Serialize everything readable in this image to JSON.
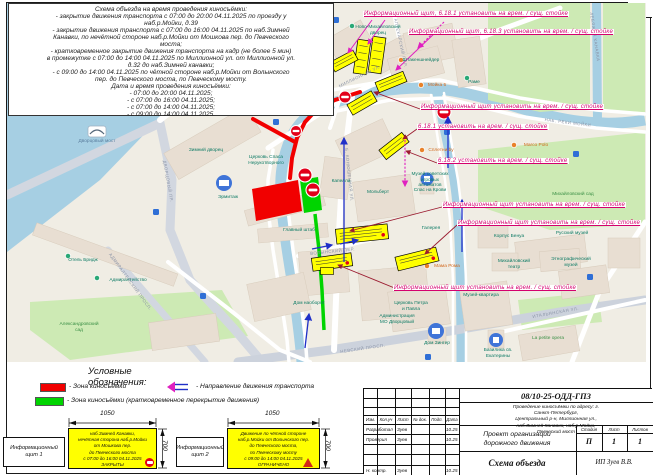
{
  "sheet": {
    "number": "16",
    "info_text": "Схема объезда на время проведения киносъёмки:\n- закрытие движения транспорта с 07:00 до 20:00 04.11.2025 по проезду у\nнаб.р.Мойки, д.39\n- закрытие движения транспорта с 07:00 до 16:00 04.11.2025 по наб.Зимней\nКанавки, по нечётной стороне наб.р.Мойки от Мошкова пер. до Певческого\nмоста;\n- кратковременное закрытие движения транспорта на кадр (не более 5 мин)\nв промежутке с 07:00 до 14:00 04.11.2025 по Миллионной ул. от Миллионной ул.\nд.32 до наб.Зимней канавки;\n- с 09:00 до 14:00 04.11.2025 по чётной стороне наб.р.Мойки от Волынского\nпер. до Певческого моста, по Певческому мосту.\nДата и время проведения киносъёмки:\n- 07:00 до 20:00 04.11.2025;\n- с 07:00 до 16:00 04.11.2025;\n- с 07:00 до 14:00 04.11.2025;\n- с 09:00 до 14:00 04.11.2025."
  },
  "annotations": [
    "Информационный щит, 6.18.1 установить на врем. / сущ. стойке",
    "Информационный щит, 6.18.3 установить на врем. / сущ. стойке",
    "Информационный щит установить на врем. / сущ. стойке",
    "6.18.1 установить на врем. / сущ. стойке",
    "6.18.2 установить на врем. / сущ. стойке",
    "Информационный щит установить на врем. / сущ. стойке",
    "Информационный щит установить на врем. / сущ. стойке",
    "Информационный щит установить на врем. / сущ. стойке"
  ],
  "map": {
    "pois": [
      "Эрмитажный театр",
      "Ново-Михайловский\nдворец",
      "Штакеншнейдер",
      "Мойка 5",
      "Раме",
      "Зимний дворец",
      "Эрмитаж",
      "Церковь Спаса\nНерукотворного",
      "Капелла",
      "Главный штаб",
      "Мольберт",
      "Музей советских\nигровых\nавтоматов",
      "Спас на Крови",
      "Михайловский сад",
      "Галерея",
      "Корпус Бенуа",
      "Русский музей",
      "Михайловский\nтеатр",
      "Этнографический\nмузей",
      "Мама Рома",
      "Музей-квартира",
      "Церковь Петра\nи Павла",
      "Администрация\nМО Дворцовый",
      "Дом наоборот",
      "Дом Зингер",
      "Базилика св.\nЕкатерины",
      "La petite opera",
      "Адмиралтейство",
      "Александровский\nсад",
      "Отель Бридж",
      "Дворцовый мост",
      "Marco Polo",
      "Сплетни.by"
    ],
    "streets": [
      "НАБ. РЕКИ МОЙКИ",
      "НЕВСКИЙ ПРОСП.",
      "АДМИРАЛТЕЙСКИЙ ПРОСП.",
      "ДВОРЦОВЫЙ ПР.",
      "МИЛЛИОННАЯ УЛ.",
      "ИТАЛЬЯНСКАЯ УЛ.",
      "АПТЕКАРСКИЙ ПЕР.",
      "ВОЛЫНСКИЙ ПЕР.",
      "Б. КОНЮШЕННАЯ УЛ.",
      "ЛЕБЯЖЬЯ КАНАВКА"
    ]
  },
  "legend": {
    "title": "Условные обозначения:",
    "items": [
      {
        "label": "-  Зона киносъёмки"
      },
      {
        "label": "-  Направление движения транспорта"
      },
      {
        "label": "-  Зона киносъёмки (кратковременное перекрытие движения)"
      }
    ],
    "signs": [
      {
        "name": "Информационный щит 1",
        "dim_w": "1050",
        "dim_h": "700",
        "text": "наб.Зимней Канавки,\nнечётная сторона наб.р.Мойки\nот Мошкова пер.\nдо Певческого моста\nс 07:00 до 16:00 04.11.2025\nЗАКРЫТЫ"
      },
      {
        "name": "Информационный щит 2",
        "dim_w": "1050",
        "dim_h": "700",
        "text": "Движение по чётной стороне\nнаб.р.Мойки от Волынского пер.\nдо Певческого моста,\nпо Певческому мосту\nс 09:00 до 14:00 04.11.2025\nОГРАНИЧЕНО"
      }
    ]
  },
  "title_block": {
    "doc_code": "08/10-25-ОДД-ГПЗ",
    "description": "Проведение киносъёмки по адресу: г. Санкт-Петербург,\nЦентральный р-н, Миллионная ул., наб.Зимней Канавки, наб.р.Мойки,\nПевческий мост",
    "project": "Проект организации\nдорожного движения",
    "sheet_title": "Схема объезда",
    "author": "ИП Зуев В.В.",
    "stage_cols": [
      "Стадия",
      "Лист",
      "Листов"
    ],
    "stage_vals": [
      "П",
      "1",
      "1"
    ],
    "cols": [
      "Изм.",
      "Кол.уч",
      "Лист",
      "№ док.",
      "Подп.",
      "Дата"
    ],
    "rows": [
      {
        "r": "Разработал",
        "n": "Зуев",
        "d": "10.25"
      },
      {
        "r": "Проверил",
        "n": "Зуев",
        "d": "10.25"
      },
      {
        "r": "",
        "n": "",
        "d": ""
      },
      {
        "r": "",
        "n": "",
        "d": ""
      },
      {
        "r": "Н. контр.",
        "n": "Зуев",
        "d": "10.25"
      }
    ]
  },
  "colors": {
    "zone_red": "#f10000",
    "zone_green": "#00d400",
    "sign_yellow": "#ffff00",
    "annotation_magenta": "#d4006e",
    "water": "#a6cfe3",
    "park": "#cdeab4"
  }
}
